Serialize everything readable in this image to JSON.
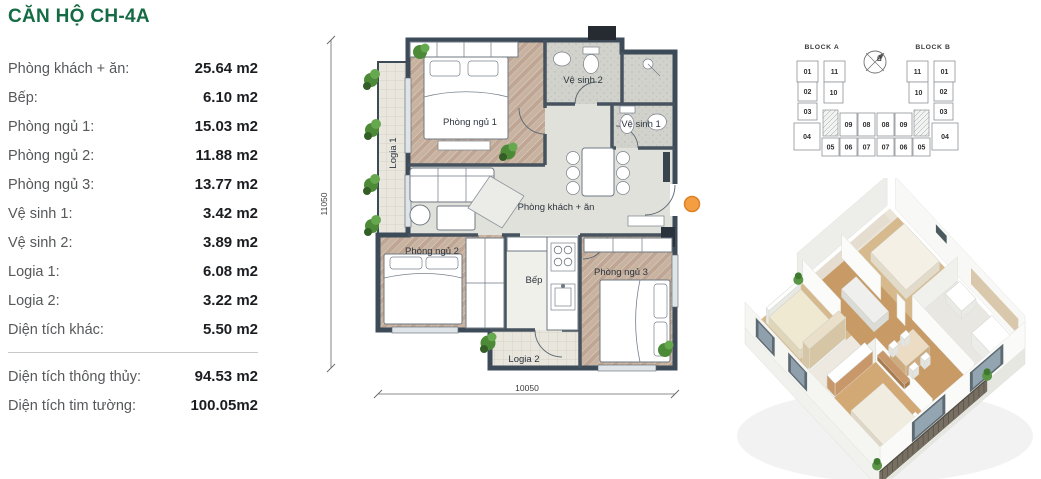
{
  "title": "CĂN HỘ CH-4A",
  "areas": {
    "rows": [
      {
        "label": "Phòng khách + ăn:",
        "value": "25.64 m2"
      },
      {
        "label": "Bếp:",
        "value": "6.10 m2"
      },
      {
        "label": "Phòng ngủ 1:",
        "value": "15.03 m2"
      },
      {
        "label": "Phòng ngủ 2:",
        "value": "11.88 m2"
      },
      {
        "label": "Phòng ngủ 3:",
        "value": "13.77 m2"
      },
      {
        "label": "Vệ sinh 1:",
        "value": "3.42 m2"
      },
      {
        "label": "Vệ sinh 2:",
        "value": "3.89 m2"
      },
      {
        "label": "Logia 1:",
        "value": "6.08 m2"
      },
      {
        "label": "Logia 2:",
        "value": "3.22 m2"
      },
      {
        "label": "Diện tích khác:",
        "value": "5.50 m2"
      }
    ],
    "totals": [
      {
        "label": "Diện tích thông thủy:",
        "value": "94.53 m2"
      },
      {
        "label": "Diện tích tim tường:",
        "value": "100.05m2"
      }
    ]
  },
  "floorplan": {
    "labels": {
      "bedroom1": "Phòng ngủ 1",
      "bedroom2": "Phòng ngủ 2",
      "bedroom3": "Phòng ngủ 3",
      "living": "Phòng khách + ăn",
      "kitchen": "Bếp",
      "wc1": "Vệ sinh 1",
      "wc2": "Vệ sinh 2",
      "logia1": "Logia 1",
      "logia2": "Logia 2"
    },
    "dim_height": "11050",
    "dim_width": "10050"
  },
  "block_map": {
    "block_a": "BLOCK A",
    "block_b": "BLOCK B",
    "compass": "B",
    "highlighted_unit": "04",
    "highlight_color": "#C4794C",
    "a_units": [
      "01",
      "11",
      "02",
      "10",
      "03",
      "04",
      "09",
      "08",
      "05",
      "06",
      "07"
    ],
    "b_units": [
      "11",
      "01",
      "10",
      "02",
      "03",
      "08",
      "09",
      "04",
      "07",
      "06",
      "05"
    ]
  },
  "colors": {
    "accent_green": "#156B43",
    "wall": "#3D4B59",
    "entry_marker": "#F49D41"
  }
}
